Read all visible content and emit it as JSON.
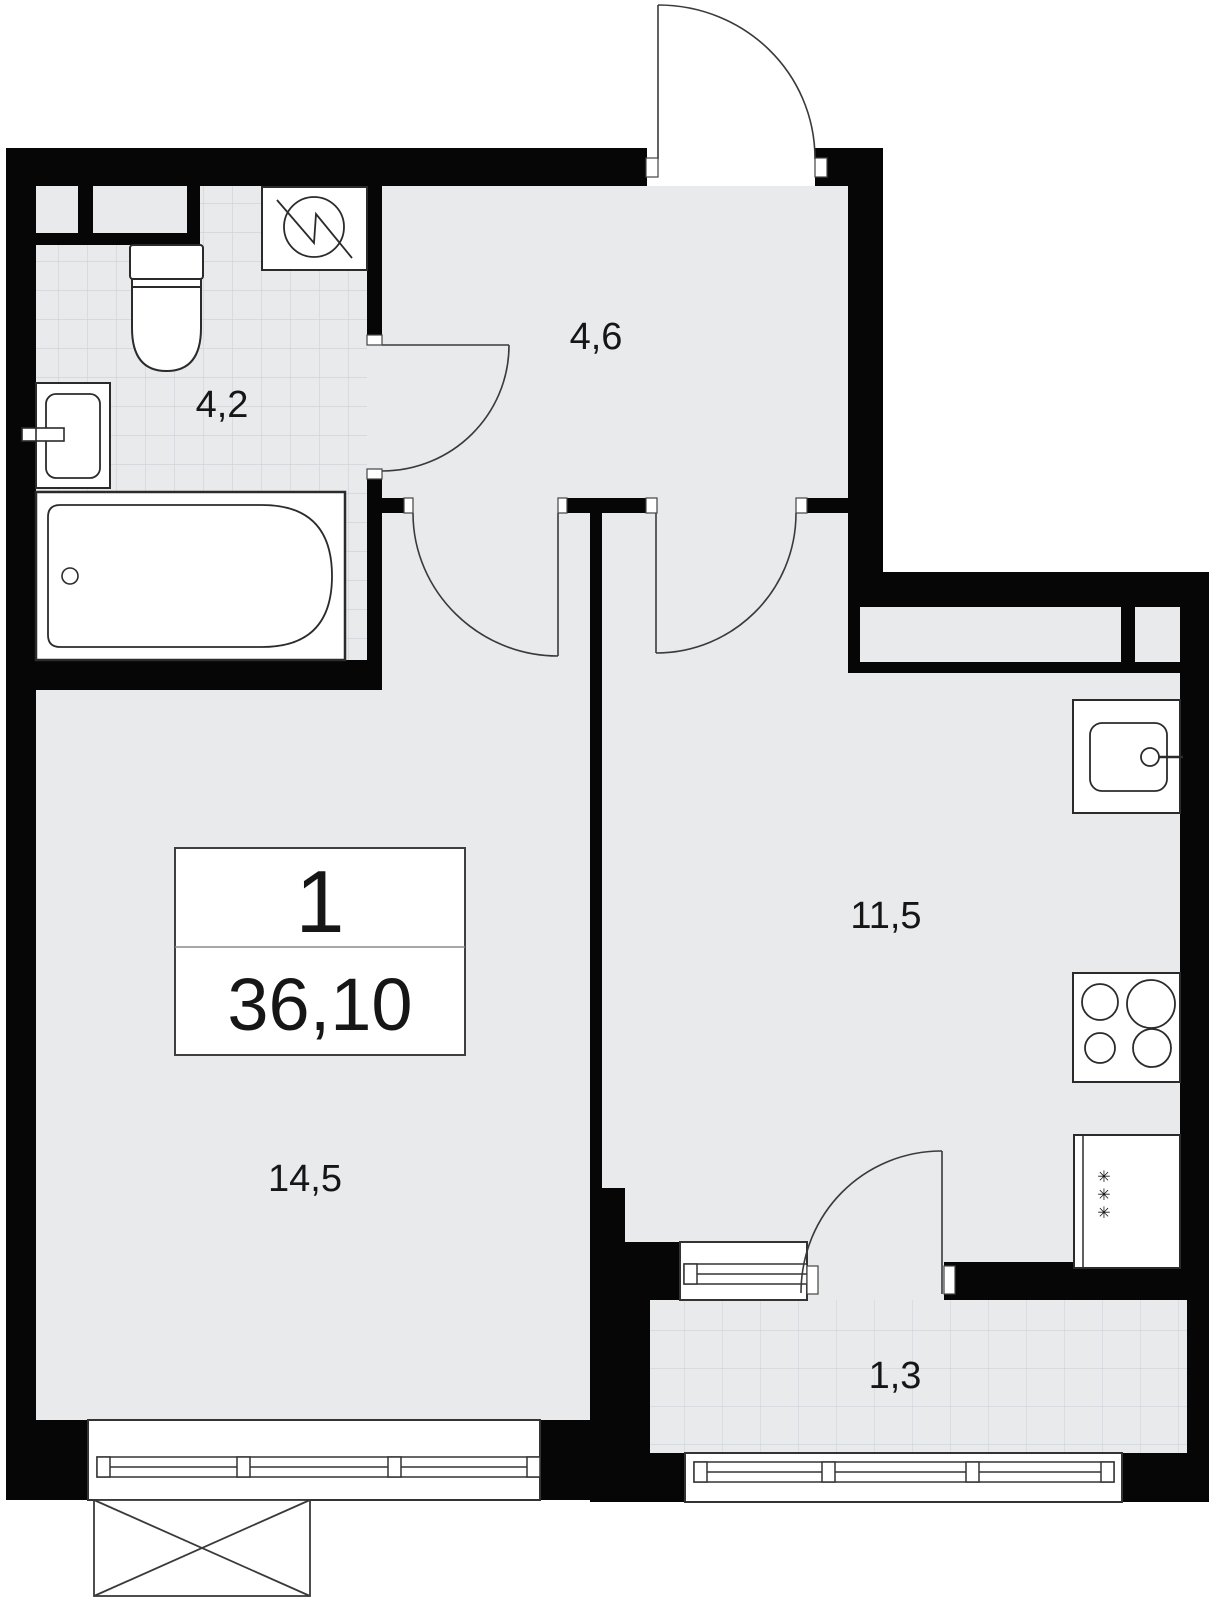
{
  "title": "Apartment floor plan",
  "info_box": {
    "rooms_count": "1",
    "total_area": "36,10"
  },
  "rooms": [
    {
      "name": "bathroom",
      "area": "4,2"
    },
    {
      "name": "hallway",
      "area": "4,6"
    },
    {
      "name": "kitchen",
      "area": "11,5"
    },
    {
      "name": "living-room",
      "area": "14,5"
    },
    {
      "name": "balcony",
      "area": "1,3"
    }
  ],
  "symbols": {
    "fridge_snowflake": "✳"
  },
  "colors": {
    "wall": "#060606",
    "floor": "#e8eaec",
    "tile_line": "#ccd1d7",
    "fixture_outline": "#2b2b2b",
    "fixture_fill": "#ffffff"
  }
}
